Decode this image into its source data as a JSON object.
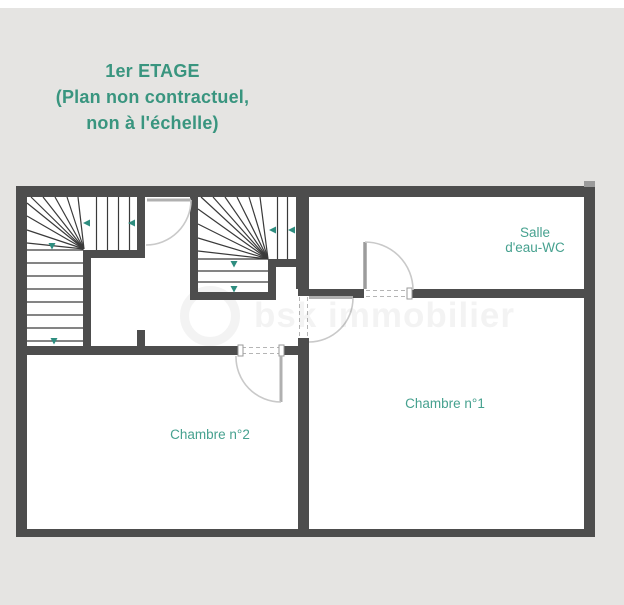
{
  "title": {
    "line1": "1er ETAGE",
    "line2": "(Plan non contractuel,",
    "line3": "non à l'échelle)"
  },
  "rooms": {
    "bathroom": {
      "line1": "Salle",
      "line2": "d'eau-WC"
    },
    "bedroom1": {
      "name": "Chambre n°1"
    },
    "bedroom2": {
      "name": "Chambre n°2"
    }
  },
  "watermark": {
    "text": "bsk immobilier"
  },
  "colors": {
    "background": "#e5e4e2",
    "wall_dark": "#4d4d4d",
    "title_teal": "#39957f",
    "label_teal": "#46a18f",
    "arrow_teal": "#2e8d7f",
    "stair_line": "#3a3a3a",
    "door_arc": "#c9c9c9",
    "door_leaf": "#a8a8a8"
  }
}
